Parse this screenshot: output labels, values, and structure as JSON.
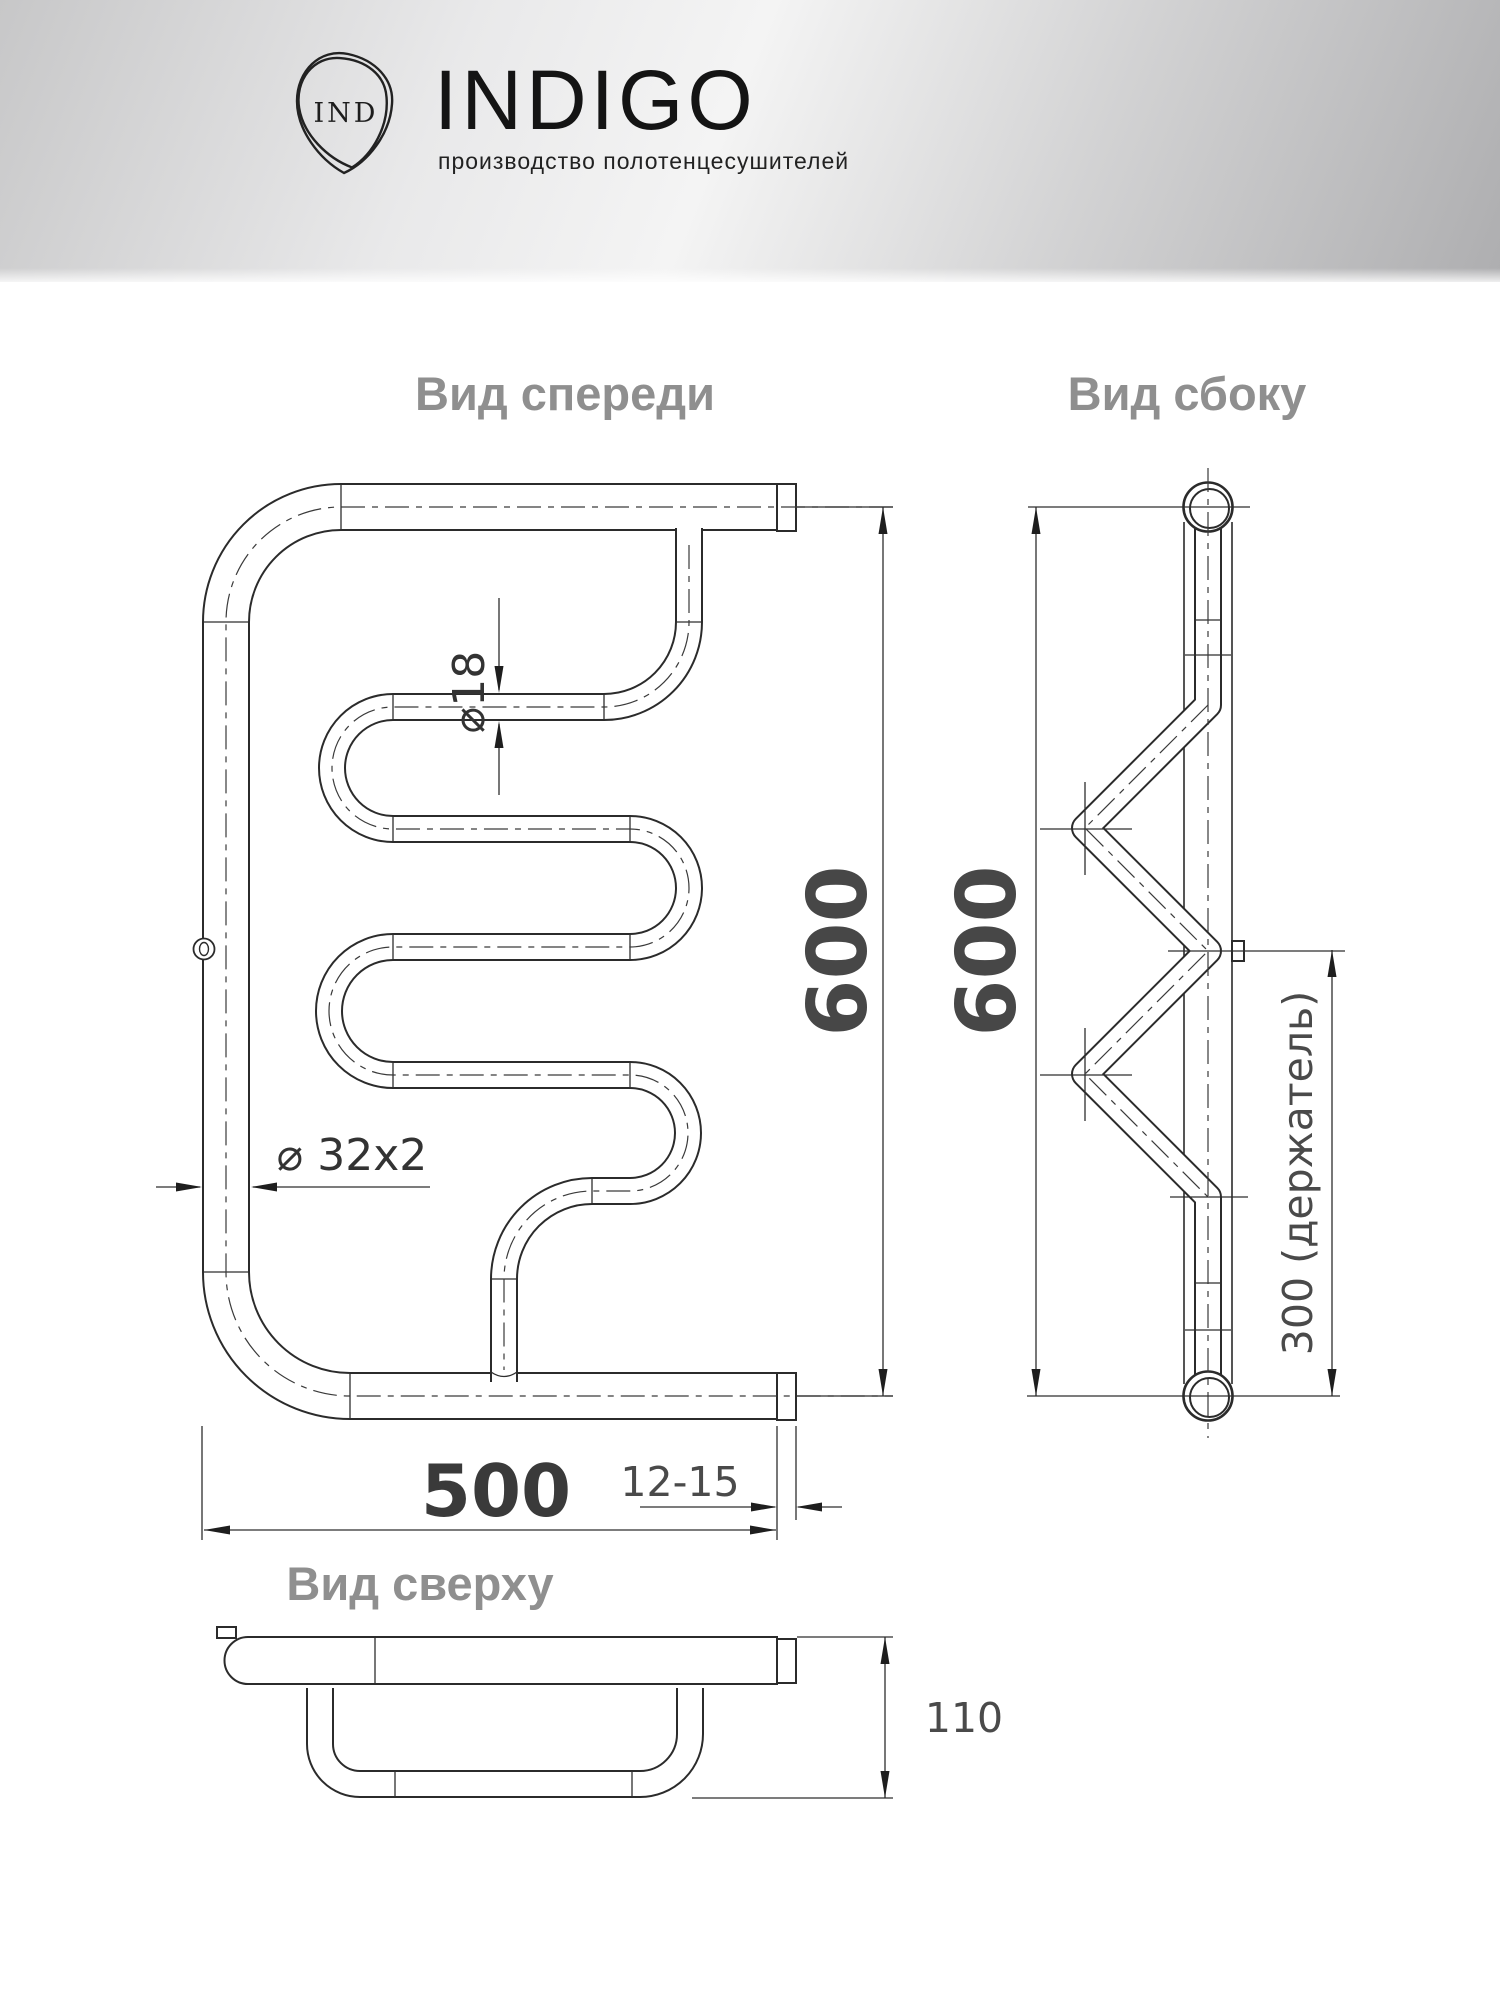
{
  "header": {
    "brand": "INDIGO",
    "monogram": "IND",
    "tagline": "производство полотенцесушителей"
  },
  "views": {
    "front": {
      "title": "Вид спереди"
    },
    "side": {
      "title": "Вид сбоку"
    },
    "top": {
      "title": "Вид сверху"
    }
  },
  "dimensions": {
    "front_height": "600",
    "side_height": "600",
    "width": "500",
    "cap_length": "12-15",
    "coil_diameter": "⌀18",
    "pipe_diameter": "⌀ 32x2",
    "holder": "300 (держатель)",
    "depth": "110"
  },
  "colors": {
    "line": "#2b2b2b",
    "dim_text": "#474747",
    "title_text": "#8f8f8f",
    "header_gradient_start": "#c7c7c8",
    "header_gradient_end": "#aeaeb0"
  }
}
